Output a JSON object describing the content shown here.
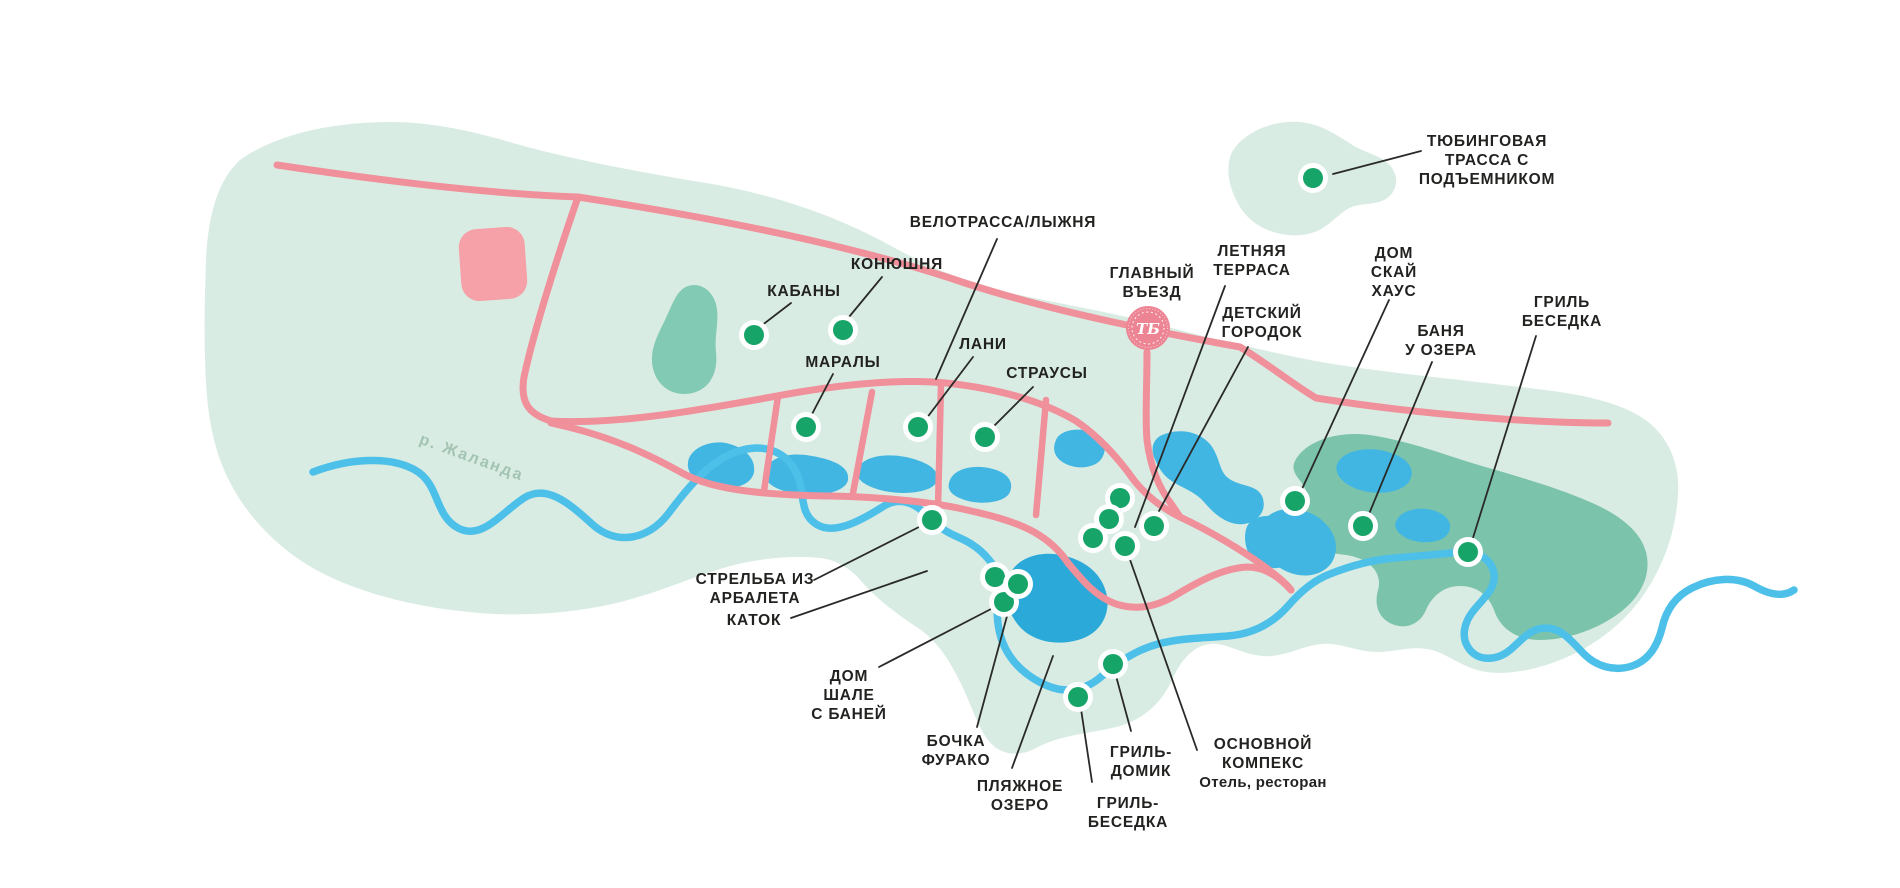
{
  "map": {
    "colors": {
      "territory": "#d9ece3",
      "forest": "#7cc3ab",
      "grove": "#82cab4",
      "lake": "#41b6e2",
      "beach_lake": "#2ba9d8",
      "river": "#4cc0e8",
      "road": "#f0909b",
      "building": "#f5a1a7",
      "marker": "#17a468",
      "marker_ring": "#ffffff",
      "label": "#222220",
      "leader": "#2a2a28",
      "river_label": "#a3c4b2",
      "badge": "#ed8494"
    },
    "river_label": {
      "text": "р. Жаланда",
      "x": 470,
      "y": 462,
      "rotation": 20
    },
    "entrance_badge": {
      "monogram": "ТБ",
      "x": 1148,
      "y": 328
    },
    "pois": [
      {
        "id": "tubing-track",
        "label": {
          "x": 1487,
          "y": 146,
          "lines": [
            "ТЮБИНГОВАЯ",
            "ТРАССА С",
            "ПОДЪЕМНИКОМ"
          ]
        },
        "leader": [
          1421,
          151,
          1333,
          174
        ],
        "markers": [
          [
            1313,
            178
          ]
        ]
      },
      {
        "id": "bike-ski-track",
        "label": {
          "x": 1003,
          "y": 227,
          "lines": [
            "ВЕЛОТРАССА/ЛЫЖНЯ"
          ]
        },
        "leader": [
          997,
          239,
          936,
          379
        ],
        "markers": []
      },
      {
        "id": "stable",
        "label": {
          "x": 897,
          "y": 269,
          "lines": [
            "КОНЮШНЯ"
          ]
        },
        "leader": [
          882,
          277,
          849,
          317
        ],
        "markers": [
          [
            843,
            330
          ]
        ]
      },
      {
        "id": "boars",
        "label": {
          "x": 804,
          "y": 296,
          "lines": [
            "КАБАНЫ"
          ]
        },
        "leader": [
          791,
          303,
          761,
          326
        ],
        "markers": [
          [
            754,
            335
          ]
        ]
      },
      {
        "id": "marals",
        "label": {
          "x": 843,
          "y": 367,
          "lines": [
            "МАРАЛЫ"
          ]
        },
        "leader": [
          833,
          374,
          811,
          416
        ],
        "markers": [
          [
            806,
            427
          ]
        ]
      },
      {
        "id": "fallow-deer",
        "label": {
          "x": 983,
          "y": 349,
          "lines": [
            "ЛАНИ"
          ]
        },
        "leader": [
          973,
          357,
          926,
          419
        ],
        "markers": [
          [
            918,
            427
          ]
        ]
      },
      {
        "id": "ostriches",
        "label": {
          "x": 1047,
          "y": 378,
          "lines": [
            "СТРАУСЫ"
          ]
        },
        "leader": [
          1033,
          387,
          992,
          428
        ],
        "markers": [
          [
            985,
            437
          ]
        ]
      },
      {
        "id": "main-entrance",
        "label": {
          "x": 1152,
          "y": 278,
          "lines": [
            "ГЛАВНЫЙ",
            "ВЪЕЗД"
          ]
        },
        "leader": null,
        "markers": []
      },
      {
        "id": "summer-terrace",
        "label": {
          "x": 1252,
          "y": 256,
          "lines": [
            "ЛЕТНЯЯ",
            "ТЕРРАСА"
          ]
        },
        "leader": [
          1225,
          286,
          1135,
          527
        ],
        "markers": []
      },
      {
        "id": "kids-playground",
        "label": {
          "x": 1262,
          "y": 318,
          "lines": [
            "ДЕТСКИЙ",
            "ГОРОДОК"
          ]
        },
        "leader": [
          1248,
          347,
          1159,
          511
        ],
        "markers": []
      },
      {
        "id": "sky-house",
        "label": {
          "x": 1394,
          "y": 258,
          "lines": [
            "ДОМ",
            "СКАЙ",
            "ХАУС"
          ]
        },
        "leader": [
          1389,
          300,
          1302,
          489
        ],
        "markers": [
          [
            1295,
            501
          ]
        ]
      },
      {
        "id": "lake-bathhouse",
        "label": {
          "x": 1441,
          "y": 336,
          "lines": [
            "БАНЯ",
            "У ОЗЕРА"
          ]
        },
        "leader": [
          1432,
          362,
          1369,
          514
        ],
        "markers": [
          [
            1363,
            526
          ]
        ]
      },
      {
        "id": "grill-gazebo-east",
        "label": {
          "x": 1562,
          "y": 307,
          "lines": [
            "ГРИЛЬ",
            "БЕСЕДКА"
          ]
        },
        "leader": [
          1536,
          336,
          1472,
          541
        ],
        "markers": [
          [
            1468,
            552
          ]
        ]
      },
      {
        "id": "crossbow-shooting",
        "label": {
          "x": 755,
          "y": 584,
          "lines": [
            "СТРЕЛЬБА ИЗ",
            "АРБАЛЕТА"
          ]
        },
        "leader": [
          814,
          580,
          919,
          527
        ],
        "markers": [
          [
            932,
            520
          ]
        ]
      },
      {
        "id": "ice-rink",
        "label": {
          "x": 754,
          "y": 625,
          "lines": [
            "КАТОК"
          ]
        },
        "leader": [
          791,
          618,
          927,
          571
        ],
        "markers": []
      },
      {
        "id": "chalet-house-bath",
        "label": {
          "x": 849,
          "y": 681,
          "lines": [
            "ДОМ",
            "ШАЛЕ",
            "С БАНЕЙ"
          ]
        },
        "leader": [
          879,
          667,
          991,
          609
        ],
        "markers": [
          [
            1004,
            602
          ],
          [
            995,
            577
          ]
        ]
      },
      {
        "id": "furako-barrel",
        "label": {
          "x": 956,
          "y": 746,
          "lines": [
            "БОЧКА",
            "ФУРАКО"
          ]
        },
        "leader": [
          977,
          727,
          1013,
          594
        ],
        "markers": [
          [
            1018,
            584
          ]
        ]
      },
      {
        "id": "beach-lake",
        "label": {
          "x": 1020,
          "y": 791,
          "lines": [
            "ПЛЯЖНОЕ",
            "ОЗЕРО"
          ]
        },
        "leader": [
          1012,
          768,
          1053,
          656
        ],
        "markers": []
      },
      {
        "id": "grill-cabin",
        "label": {
          "x": 1141,
          "y": 757,
          "lines": [
            "ГРИЛЬ-",
            "ДОМИК"
          ]
        },
        "leader": [
          1131,
          731,
          1116,
          676
        ],
        "markers": [
          [
            1113,
            664
          ]
        ]
      },
      {
        "id": "grill-gazebo-south",
        "label": {
          "x": 1128,
          "y": 808,
          "lines": [
            "ГРИЛЬ-",
            "БЕСЕДКА"
          ]
        },
        "leader": [
          1092,
          782,
          1081,
          709
        ],
        "markers": [
          [
            1078,
            697
          ]
        ]
      },
      {
        "id": "main-complex",
        "label": {
          "x": 1263,
          "y": 749,
          "lines": [
            "ОСНОВНОЙ",
            "КОМПЕКС"
          ],
          "sub": "Отель, ресторан"
        },
        "leader": [
          1197,
          750,
          1128,
          554
        ],
        "markers": [
          [
            1125,
            546
          ],
          [
            1120,
            498
          ],
          [
            1109,
            519
          ],
          [
            1093,
            538
          ],
          [
            1154,
            526
          ]
        ]
      }
    ]
  }
}
